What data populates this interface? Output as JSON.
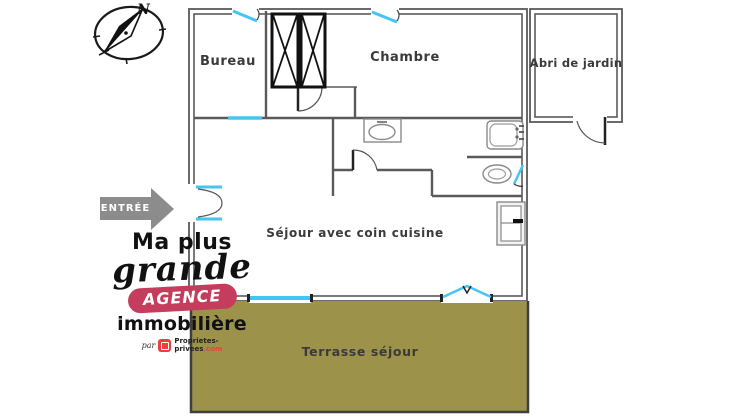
{
  "plan": {
    "rooms": [
      {
        "name": "bureau",
        "label": "Bureau"
      },
      {
        "name": "chambre",
        "label": "Chambre"
      },
      {
        "name": "abri-de-jardin",
        "label": "Abri de jardin"
      },
      {
        "name": "sejour",
        "label": "Séjour avec coin cuisine"
      },
      {
        "name": "terrasse",
        "label": "Terrasse séjour"
      }
    ],
    "entrance_label": "ENTRÉE",
    "compass_north_label": "N",
    "colors": {
      "wall": "#5a5a5a",
      "window": "#45c6f2",
      "terrace_fill": "#9c9249",
      "terrace_border": "#3f3f3f",
      "entrance_arrow": "#8c8c8c",
      "logo_badge": "#c43d5c",
      "brand_red": "#e8413d"
    }
  },
  "logo": {
    "line1": "Ma plus",
    "line2": "grande",
    "badge": "AGENCE",
    "line3": "immobilière",
    "by_prefix": "par",
    "brand_line1": "Proprietes-",
    "brand_line2": "privees",
    "brand_tld": ".com"
  }
}
